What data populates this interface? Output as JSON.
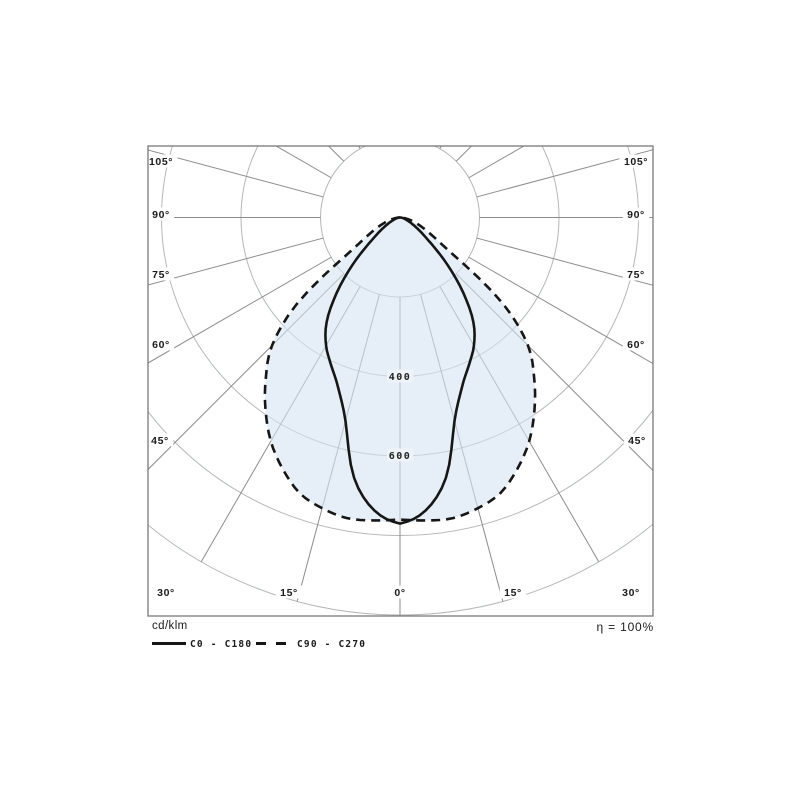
{
  "legend": {
    "unit_label": "cd/klm",
    "series": [
      {
        "label": "C0 - C180",
        "style": "solid"
      },
      {
        "label": "C90 - C270",
        "style": "dashed"
      }
    ],
    "efficiency_label": "η = 100%"
  },
  "chart_data": {
    "type": "polar_photometric",
    "unit": "cd/klm",
    "efficiency": "100%",
    "center": {
      "x": 400,
      "y": 217.5
    },
    "frame": {
      "x": 148,
      "y": 146,
      "w": 505,
      "h": 470
    },
    "scale_px_per_unit": 0.3975,
    "ring_values": [
      200,
      400,
      600,
      800,
      1000
    ],
    "ring_step": 200,
    "inner_radius_value": 200,
    "ray_angle_step_deg": 15,
    "max_ray_angle_deg": 180,
    "angles_deg": [
      0,
      5,
      10,
      15,
      20,
      25,
      30,
      35,
      40,
      45,
      50,
      55,
      60,
      65,
      70,
      75,
      80,
      85,
      90
    ],
    "series": [
      {
        "name": "C0 - C180",
        "dash": false,
        "values": [
          770,
          740,
          665,
          530,
          455,
          410,
          372,
          322,
          248,
          170,
          103,
          65,
          42,
          27,
          17,
          11,
          6,
          3,
          0
        ]
      },
      {
        "name": "C90 - C270",
        "dash": true,
        "values": [
          760,
          765,
          768,
          757,
          738,
          698,
          650,
          590,
          525,
          455,
          340,
          165,
          100,
          68,
          46,
          30,
          16,
          7,
          0
        ]
      }
    ],
    "degree_labels": [
      {
        "text": "105°",
        "x": 161,
        "y": 161
      },
      {
        "text": "90°",
        "x": 161,
        "y": 214
      },
      {
        "text": "75°",
        "x": 161,
        "y": 274
      },
      {
        "text": "60°",
        "x": 161,
        "y": 344
      },
      {
        "text": "45°",
        "x": 160,
        "y": 440
      },
      {
        "text": "30°",
        "x": 166,
        "y": 592
      },
      {
        "text": "15°",
        "x": 289,
        "y": 592
      },
      {
        "text": "0°",
        "x": 400,
        "y": 592
      },
      {
        "text": "15°",
        "x": 513,
        "y": 592
      },
      {
        "text": "30°",
        "x": 631,
        "y": 592
      },
      {
        "text": "45°",
        "x": 637,
        "y": 440
      },
      {
        "text": "60°",
        "x": 636,
        "y": 344
      },
      {
        "text": "75°",
        "x": 636,
        "y": 274
      },
      {
        "text": "90°",
        "x": 636,
        "y": 214
      },
      {
        "text": "105°",
        "x": 636,
        "y": 161
      }
    ],
    "value_labels": [
      {
        "text": "400",
        "x": 400,
        "y": 376
      },
      {
        "text": "600",
        "x": 400,
        "y": 455
      }
    ],
    "colors": {
      "ray": "#8c8c8c",
      "ring": "#b4b8bb",
      "frame": "#787878",
      "curve": "#161616",
      "fill": "rgba(213,228,241,0.60)",
      "label": "#1a1a1a",
      "background": "#ffffff",
      "value_label_knockout": "#eef3f8",
      "degree_label_knockout": "#ffffff"
    }
  }
}
